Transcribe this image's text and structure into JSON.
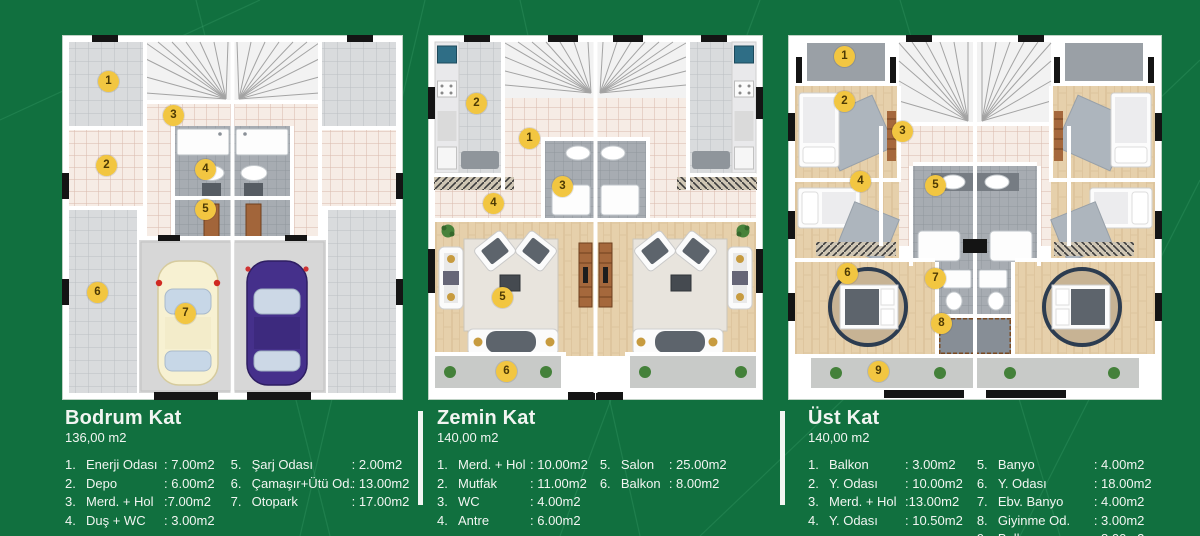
{
  "colors": {
    "background": "#11703f",
    "accent_line": "#46a872",
    "badge_bg": "#f2c641",
    "badge_text": "#4d3a05",
    "text": "#f1f5f1",
    "wall": "#ffffff"
  },
  "plans": [
    {
      "id": "bodrum-kat",
      "badges": [
        "1",
        "2",
        "3",
        "4",
        "5",
        "6",
        "7"
      ]
    },
    {
      "id": "zemin-kat",
      "badges": [
        "1",
        "2",
        "3",
        "4",
        "5",
        "6"
      ]
    },
    {
      "id": "ust-kat",
      "badges": [
        "1",
        "2",
        "3",
        "4",
        "5",
        "6",
        "7",
        "8",
        "9"
      ]
    }
  ],
  "legends": [
    {
      "title": "Bodrum Kat",
      "area": "136,00 m2",
      "col1": [
        {
          "num": "1.",
          "name": "Enerji Odası",
          "value": ": 7.00m2"
        },
        {
          "num": "2.",
          "name": "Depo",
          "value": ": 6.00m2"
        },
        {
          "num": "3.",
          "name": "Merd. + Hol",
          "value": ":7.00m2"
        },
        {
          "num": "4.",
          "name": "Duş + WC",
          "value": ": 3.00m2"
        }
      ],
      "col2": [
        {
          "num": "5.",
          "name": "Şarj Odası",
          "value": ": 2.00m2"
        },
        {
          "num": "6.",
          "name": "Çamaşır+Ütü Od.",
          "value": ": 13.00m2"
        },
        {
          "num": "7.",
          "name": "Otopark",
          "value": ": 17.00m2"
        }
      ]
    },
    {
      "title": "Zemin Kat",
      "area": "140,00 m2",
      "col1": [
        {
          "num": "1.",
          "name": "Merd. + Hol",
          "value": ": 10.00m2"
        },
        {
          "num": "2.",
          "name": "Mutfak",
          "value": ": 11.00m2"
        },
        {
          "num": "3.",
          "name": "WC",
          "value": ": 4.00m2"
        },
        {
          "num": "4.",
          "name": "Antre",
          "value": ": 6.00m2"
        }
      ],
      "col2": [
        {
          "num": "5.",
          "name": "Salon",
          "value": ": 25.00m2"
        },
        {
          "num": "6.",
          "name": "Balkon",
          "value": ": 8.00m2"
        }
      ]
    },
    {
      "title": "Üst Kat",
      "area": "140,00 m2",
      "col1": [
        {
          "num": "1.",
          "name": "Balkon",
          "value": ": 3.00m2"
        },
        {
          "num": "2.",
          "name": "Y. Odası",
          "value": ": 10.00m2"
        },
        {
          "num": "3.",
          "name": "Merd. + Hol",
          "value": ":13.00m2"
        },
        {
          "num": "4.",
          "name": "Y. Odası",
          "value": ": 10.50m2"
        }
      ],
      "col2": [
        {
          "num": "5.",
          "name": "Banyo",
          "value": ": 4.00m2"
        },
        {
          "num": "6.",
          "name": "Y. Odası",
          "value": ": 18.00m2"
        },
        {
          "num": "7.",
          "name": "Ebv. Banyo",
          "value": ": 4.00m2"
        },
        {
          "num": "8.",
          "name": "Giyinme Od.",
          "value": ": 3.00m2"
        },
        {
          "num": "9.",
          "name": "Balkon",
          "value": ": 8.00m2"
        }
      ]
    }
  ]
}
